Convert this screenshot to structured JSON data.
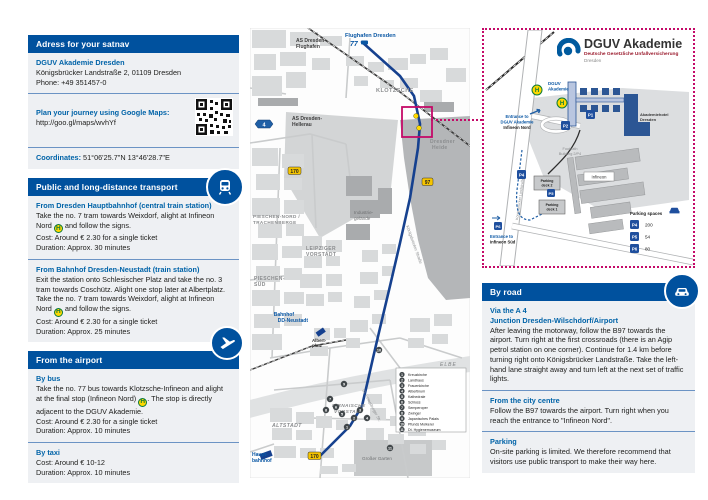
{
  "colors": {
    "header_blue": "#00519e",
    "accent_blue": "#0063a8",
    "magenta": "#c40a68",
    "route_blue": "#16418f",
    "stop_yellow": "#ffd800",
    "logo_blue": "#005a9e"
  },
  "satnav": {
    "header": "Adress for your satnav",
    "name": "DGUV Akademie Dresden",
    "address": "Königsbrücker Landstraße 2, 01109 Dresden",
    "phone": "Phone: +49 351457-0",
    "maps_label": "Plan your journey using Google Maps:",
    "maps_url": "http://goo.gl/maps/wvhYf",
    "coordinates_label": "Coordinates:",
    "coordinates_value": "51°06'25.7\"N 13°46'28.7\"E"
  },
  "transport": {
    "header": "Public and long-distance transport",
    "h_label": "H",
    "hbf": {
      "title": "From Dresden Hauptbahnhof (central train station)",
      "body_before": "Take the no. 7 tram towards Weixdorf, alight at Infineon Nord",
      "body_after": "and follow the signs.",
      "cost": "Cost: Around € 2.30 for a single ticket",
      "duration": "Duration: Approx. 30 minutes"
    },
    "neustadt": {
      "title": "From Bahnhof Dresden-Neustadt (train station)",
      "body_before": "Exit the station onto Schlesischer Platz and take the no. 3 tram towards Coschütz. Alight one stop later at Albertplatz. Take the no. 7 tram towards Weixdorf, alight at Infineon Nord",
      "body_after": "and follow the signs.",
      "cost": "Cost: Around € 2.30 for a single ticket",
      "duration": "Duration: Approx. 25 minutes"
    }
  },
  "airport": {
    "header": "From the airport",
    "bus": {
      "title": "By bus",
      "body_before": "Take the no. 77 bus towards Klotzsche-Infineon and alight at the final stop (Infineon Nord)",
      "body_after": ". The stop is directly adjacent to the DGUV Akademie.",
      "cost": "Cost: Around € 2.30 for a single ticket",
      "duration": "Duration: Approx. 10 minutes"
    },
    "taxi": {
      "title": "By taxi",
      "cost": "Cost: Around € 10-12",
      "duration": "Duration: Approx. 10 minutes"
    }
  },
  "road": {
    "header": "By road",
    "a4": {
      "title1": "Via the A 4",
      "title2": "Junction Dresden-Wilschdorf/Airport",
      "body": "After leaving the motorway, follow the B97 towards the airport. Turn right at the first crossroads (there is an Agip petrol station on one corner). Continue for 1.4 km before turning right onto Königsbrücker Landstraße. Take the left-hand lane straight away and turn left at the next set of traffic lights."
    },
    "centre": {
      "title": "From the city centre",
      "body": "Follow the B97 towards the airport. Turn right when you reach the entrance to \"Infineon Nord\"."
    },
    "parking": {
      "title": "Parking",
      "body": "On-site parking is limited. We therefore recommend that visitors use public transport to make their way here."
    }
  },
  "city_map": {
    "airport": "Flughafen Dresden",
    "bus_line": "77",
    "as_flughafen_1": "AS Dresden-",
    "as_flughafen_2": "Flughafen",
    "klotzsche": "KLOTZSCHE",
    "as_hellerau_1": "AS Dresden-",
    "as_hellerau_2": "Hellerau",
    "heide_1": "Dresdner",
    "heide_2": "Heide",
    "pieschen_nord_1": "PIESCHEN-NORD /",
    "pieschen_nord_2": "TRACHENBERGE",
    "industrie_1": "Industrie-",
    "industrie_2": "gelände",
    "leipziger_1": "LEIPZIGER",
    "leipziger_2": "VORSTADT",
    "pieschen_sued_1": "PIESCHEN-",
    "pieschen_sued_2": "SÜD",
    "bahnhof_neustadt_1": "Bahnhof",
    "bahnhof_neustadt_2": "DD-Neustadt",
    "elbe": "ELBE",
    "albertplatz_1": "Albert-",
    "albertplatz_2": "platz",
    "pirnaische_1": "PIRNAISCHE",
    "pirnaische_2": "VORSTADT",
    "altstadt": "ALTSTADT",
    "hauptbahnhof_1": "Haupt-",
    "hauptbahnhof_2": "bahnhof",
    "grosser_garten": "Großer Garten",
    "koenigsbruecker": "Königsbrücker Straße",
    "petersburger": "St. Petersburger Str.",
    "shield_a4": "4",
    "shield_b170": "170",
    "shield_b97": "97",
    "shield_b170_b": "170",
    "legend": {
      "items": [
        {
          "n": "1",
          "label": "Kreuzkirche"
        },
        {
          "n": "2",
          "label": "Landhaus"
        },
        {
          "n": "3",
          "label": "Frauenkirche"
        },
        {
          "n": "4",
          "label": "Albertinum"
        },
        {
          "n": "5",
          "label": "Kathedrale"
        },
        {
          "n": "6",
          "label": "Schloss"
        },
        {
          "n": "7",
          "label": "Semperoper"
        },
        {
          "n": "8",
          "label": "Zwinger"
        },
        {
          "n": "9",
          "label": "Japanisches Palais"
        },
        {
          "n": "10",
          "label": "Pfunds Molkerei"
        },
        {
          "n": "11",
          "label": "Dt. Hygienemuseum"
        }
      ]
    }
  },
  "detail_map": {
    "logo_title": "DGUV Akademie",
    "logo_subtitle": "Deutsche Gesetzliche Unfallversicherung",
    "logo_city": "Dresden",
    "akademie_1": "DGUV",
    "akademie_2": "Akademie",
    "entrance_nord_1": "Entrance to",
    "entrance_nord_2": "DGUV Akademie",
    "entrance_nord_3": "Infineon Nord",
    "hotel_1": "Akademiehotel",
    "hotel_2": "Dresden",
    "infineon": "Infineon",
    "footpath_1": "Footpath",
    "footpath_2": "Building 2/P4",
    "deck2_1": "Parking",
    "deck2_2": "deck 2",
    "deck1_1": "Parking",
    "deck1_2": "deck 1",
    "entrance_sued_1": "Entrance to",
    "entrance_sued_2": "Infineon Süd",
    "street": "Königsbrücker Landstraße",
    "h_stop": "H",
    "p1": "P1",
    "p2": "P2",
    "legend": {
      "title": "Parking spaces",
      "rows": [
        {
          "icon": "P4",
          "count": "200"
        },
        {
          "icon": "P5",
          "count": "54"
        },
        {
          "icon": "P6",
          "count": "80"
        }
      ]
    }
  }
}
